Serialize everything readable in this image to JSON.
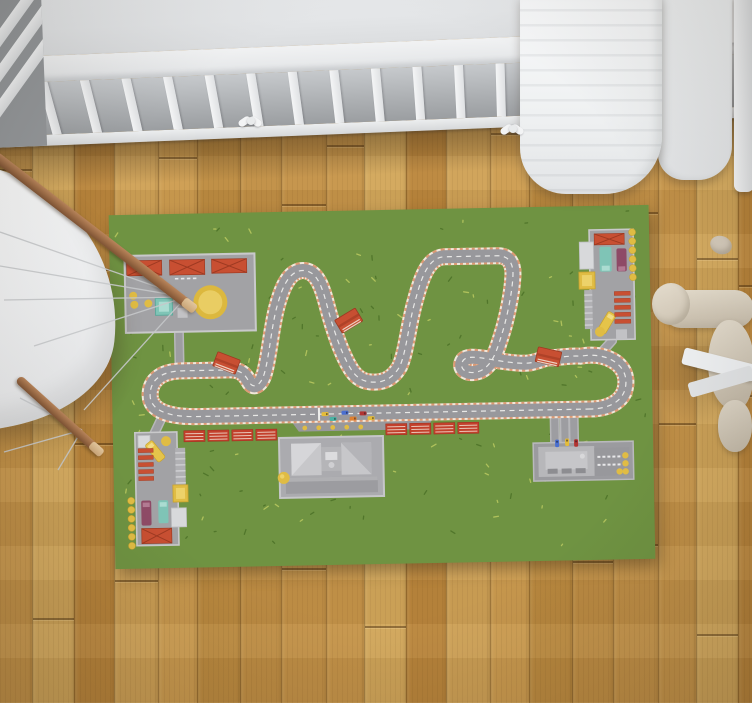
{
  "palette": {
    "rug_green": "#6f9342",
    "grass_dark": "#4e7329",
    "grass_light": "#b6c75e",
    "asphalt": "#98989c",
    "curb_orange": "#dd9a74",
    "curb_white": "#f2e7da",
    "center_line": "#f6f6f3",
    "road_core": "#9d9da1",
    "road_edge": "#b7b7ba",
    "platform": "#a2a2a5",
    "platform_border": "#c9c9cb",
    "roof_red": "#c84f32",
    "roof_red_dark": "#9e3a22",
    "stand_red": "#c3402c",
    "yellow": "#e0bc44",
    "yellow_light": "#edd26a",
    "teal": "#7fc4b6",
    "teal_light": "#abdcd1",
    "maroon": "#8e4a66",
    "bldg_white": "#d8d9db",
    "pit_base": "#ababaf",
    "pit_roof": "#c7c7ca",
    "crib_white": "#eef0f1",
    "leg_brown": "#a9754e",
    "wire_gray": "#c6c8ca",
    "wood_seam": "#7a5a28"
  },
  "floor": {
    "material": "oak planks, vertical",
    "plank_shades": [
      "#c6954a",
      "#cfa156",
      "#bd8b40",
      "#d2a75b",
      "#c39148",
      "#ba863c",
      "#cc9c50",
      "#c08e44"
    ],
    "plank_base_width": 38
  },
  "scene": {
    "room": "nursery viewed from above",
    "crib": {
      "color": "#eef0f1",
      "slat_count": 18,
      "bow_count": 2,
      "blanket": "white quilted blanket draped over right rail"
    },
    "chair": {
      "style": "white shell chair, wooden dowel legs, wire struts",
      "shell_color": "#f2f3f4",
      "leg_color": "#a9754e"
    },
    "plush_toy": {
      "position": "right edge",
      "color": "#d6cdbe",
      "ribbon_color": "#eef0f2"
    },
    "rug_theme": "race-track play mat"
  },
  "rug": {
    "track": {
      "path": "M 478 203 L 84 203 C 58 203 38 197 38 181 C 38 164 52 157 70 157 L 118 157 C 128 157 133 161 137 169 C 141 177 149 174 153 160 C 158 143 161 112 167 93 C 172 76 179 59 193 59 C 207 59 212 76 216 92 C 221 113 229 141 239 158 C 245 168 252 172 263 172 C 274 172 282 167 288 157 C 295 143 298 113 305 91 C 311 70 318 49 334 48 L 388 48 C 400 48 404 57 403 69 C 402 85 396 112 390 129 C 386 141 381 158 368 163 C 356 167 347 161 351 153 C 354 147 365 149 377 151 C 392 154 404 156 414 156 C 425 156 431 151 439 151 C 449 151 459 149 469 150 C 494 146 514 158 514 176 C 514 195 498 203 478 203 Z",
      "curb_width": 17,
      "asphalt_width": 13,
      "center_dash": "5 4.5",
      "curb_dash": "3 3",
      "start_line": {
        "x": 205.5,
        "y": 196.5,
        "w": 2,
        "h": 13
      }
    },
    "access_roads": [
      "M68 118 L68 158",
      "M48 206 L37 228",
      "M486 151 L501 135",
      "M442 206 L442 241",
      "M452 206 L452 241",
      "M461 206 L461 241"
    ],
    "pit_apron": {
      "points": "174,203 324,203 314,220 186,220",
      "wall_dash_y": 211,
      "dots_y": 216.5,
      "dots_x": [
        192,
        206,
        220,
        234,
        248
      ]
    },
    "grid_cars": [
      {
        "x": 209,
        "y": 201,
        "c": "#e4bc3a"
      },
      {
        "x": 229,
        "y": 200,
        "c": "#4a6fd0"
      },
      {
        "x": 247,
        "y": 201,
        "c": "#b23431"
      },
      {
        "x": 217,
        "y": 206,
        "c": "#49b3a4"
      },
      {
        "x": 237,
        "y": 206,
        "c": "#df8031"
      },
      {
        "x": 255,
        "y": 206,
        "c": "#e4bc3a"
      }
    ],
    "garage_cars": [
      {
        "x": 442,
        "y": 233,
        "c": "#4a6fd0"
      },
      {
        "x": 452,
        "y": 232,
        "c": "#e4bc3a"
      },
      {
        "x": 461,
        "y": 233,
        "c": "#b23431"
      }
    ],
    "stands": {
      "left_xs": [
        71,
        95,
        119,
        143
      ],
      "left_y": 217,
      "right_xs": [
        273,
        297,
        321,
        345
      ],
      "right_y": 214,
      "w": 21,
      "h": 11
    },
    "bridges": [
      {
        "x": 115,
        "y": 150,
        "r": 22
      },
      {
        "x": 238,
        "y": 110,
        "r": -30
      },
      {
        "x": 437,
        "y": 150,
        "r": 14
      }
    ],
    "decor": {
      "dot_columns": [
        {
          "x": 523,
          "y0": 27,
          "step": 9,
          "n": 6
        },
        {
          "x": 17,
          "y0": 286,
          "step": 9,
          "n": 6
        }
      ],
      "building_dots": [
        [
          23,
          81
        ],
        [
          24,
          90
        ],
        [
          38,
          89
        ],
        [
          512,
          250
        ],
        [
          512,
          258
        ],
        [
          512,
          266
        ],
        [
          506,
          266
        ]
      ],
      "stripe_rows": [
        {
          "x": 504,
          "y0": 86,
          "step": 7,
          "n": 5,
          "w": 16,
          "h": 4
        },
        {
          "x": 25,
          "y0": 234,
          "step": 7,
          "n": 5,
          "w": 15,
          "h": 4
        }
      ],
      "garage_dashes": {
        "x0": 484,
        "step": 5,
        "n": 5,
        "rows": [
          250,
          258
        ]
      },
      "parking_dashes": {
        "x0": 65,
        "step": 6,
        "n": 4,
        "y": 64
      }
    },
    "tufts": {
      "count": 160,
      "seed": 7
    }
  }
}
